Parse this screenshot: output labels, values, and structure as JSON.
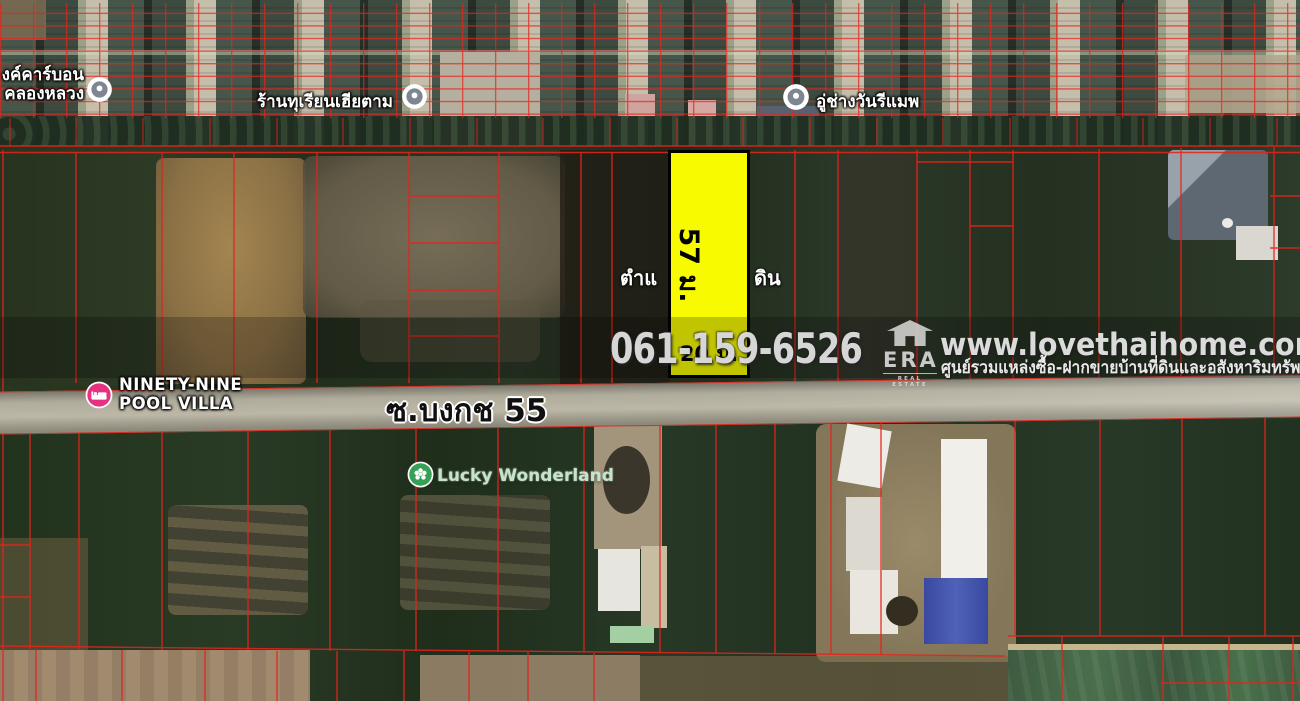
{
  "map": {
    "road_label": "ซ.บงกช 55",
    "pois": {
      "carbon": {
        "line1": "งค์คาร์บอน",
        "line2": "คลองหลวง"
      },
      "durian_shop": {
        "label": "ร้านทุเรียนเฮียตาม"
      },
      "garage": {
        "label": "อู่ช่างวันรีแมพ"
      },
      "pool_villa": {
        "line1": "NINETY-NINE",
        "line2": "POOL VILLA"
      },
      "lucky_wonderland": {
        "label": "Lucky Wonderland"
      }
    },
    "colors": {
      "parcel_line": "#e6231b",
      "poi_pin_gray": "#7d8691",
      "poi_pin_pink": "#e5317f",
      "poi_pin_green": "#36a057"
    }
  },
  "plot": {
    "depth_label": "57 ม.",
    "frontage_label": "20 ม.",
    "covered_text_fragment_left": "ตำแ",
    "covered_text_fragment_right": "ดิน",
    "fill_color": "#f8fb00",
    "border_color": "#000000"
  },
  "watermark": {
    "phone": "061-159-6526",
    "website": "www.lovethaihome.com",
    "tagline": "ศูนย์รวมแหล่งซื้อ-ฝากขายบ้านที่ดินและอสังหาริมทรัพย์",
    "brand": "ERA",
    "brand_caption": "REAL ESTATE"
  }
}
